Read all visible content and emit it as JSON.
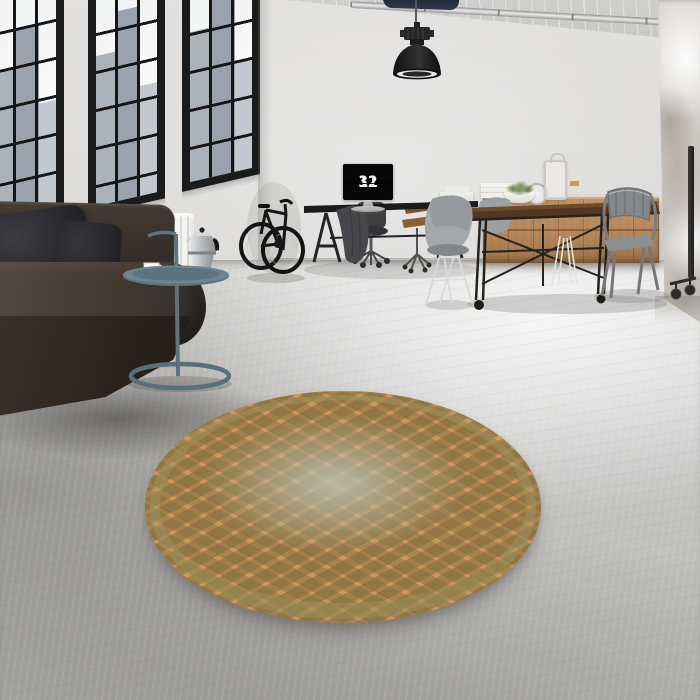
{
  "meta": {
    "type": "interior-photograph",
    "description": "Industrial loft living room: black-framed factory windows, dark leather sofa, side table with moka pot, bicycle, desk with flip-clock monitor, wooden dining set with metal chairs, and a round vintage orange rug on a concrete floor."
  },
  "monitor": {
    "device": "desktop-monitor-flip-clock",
    "hours": "11",
    "minutes": "32"
  },
  "objects": {
    "window_wall": "three tall black steel-framed windows with city view",
    "pendant_lamp": "black industrial dome pendant lamp",
    "sofa": "dark espresso leather sofa with two charcoal cushions",
    "radiator": "white wall radiator",
    "side_table": "teal tubular loop side table",
    "moka_pot": "stainless stovetop espresso maker",
    "coffee_cup": "white cup and saucer",
    "bicycle": "black fixed-gear bicycle leaning on wall",
    "desk": "black trestle desk with monitor and draped jacket",
    "office_chair": "dark swivel chair on casters",
    "wooden_chair": "brown wooden seat chair",
    "shell_chair": "grey shell chair with wire eiffel legs",
    "dining_table": "dark wood top cast-iron base table with caster feet",
    "tolix_armchair": "grey metal tolix-style armchair",
    "sideboard": "light wood apothecary sideboard",
    "storage_boxes": "three charcoal boxes with brass latches",
    "decor": "books, moss plant in white bowl, table clock, white lantern",
    "clothes_rack": "black rolling rack pole at right edge",
    "rug": "round distressed orange oriental rug with diamond lattice and faded center",
    "right_wall": "distressed plaster wall",
    "ceiling_pipe": "silver pipe along ceiling"
  },
  "palette": {
    "wall": "#dcdbd9",
    "window_frame": "#1b1b1b",
    "floor_light": "#e8e7e5",
    "floor_dark": "#a5a3a1",
    "sofa_leather": "#3a322c",
    "cushion": "#232328",
    "side_table_teal": "#5d7480",
    "rug_base": "#d0975a",
    "rug_motif": "#7d704e",
    "rug_center_fade": "#bcc2b4",
    "table_wood": "#523824",
    "sideboard_wood": "#b2855a",
    "brass": "#c89f3e",
    "chair_grey": "#8d9092",
    "lamp_black": "#1a1a1c"
  }
}
